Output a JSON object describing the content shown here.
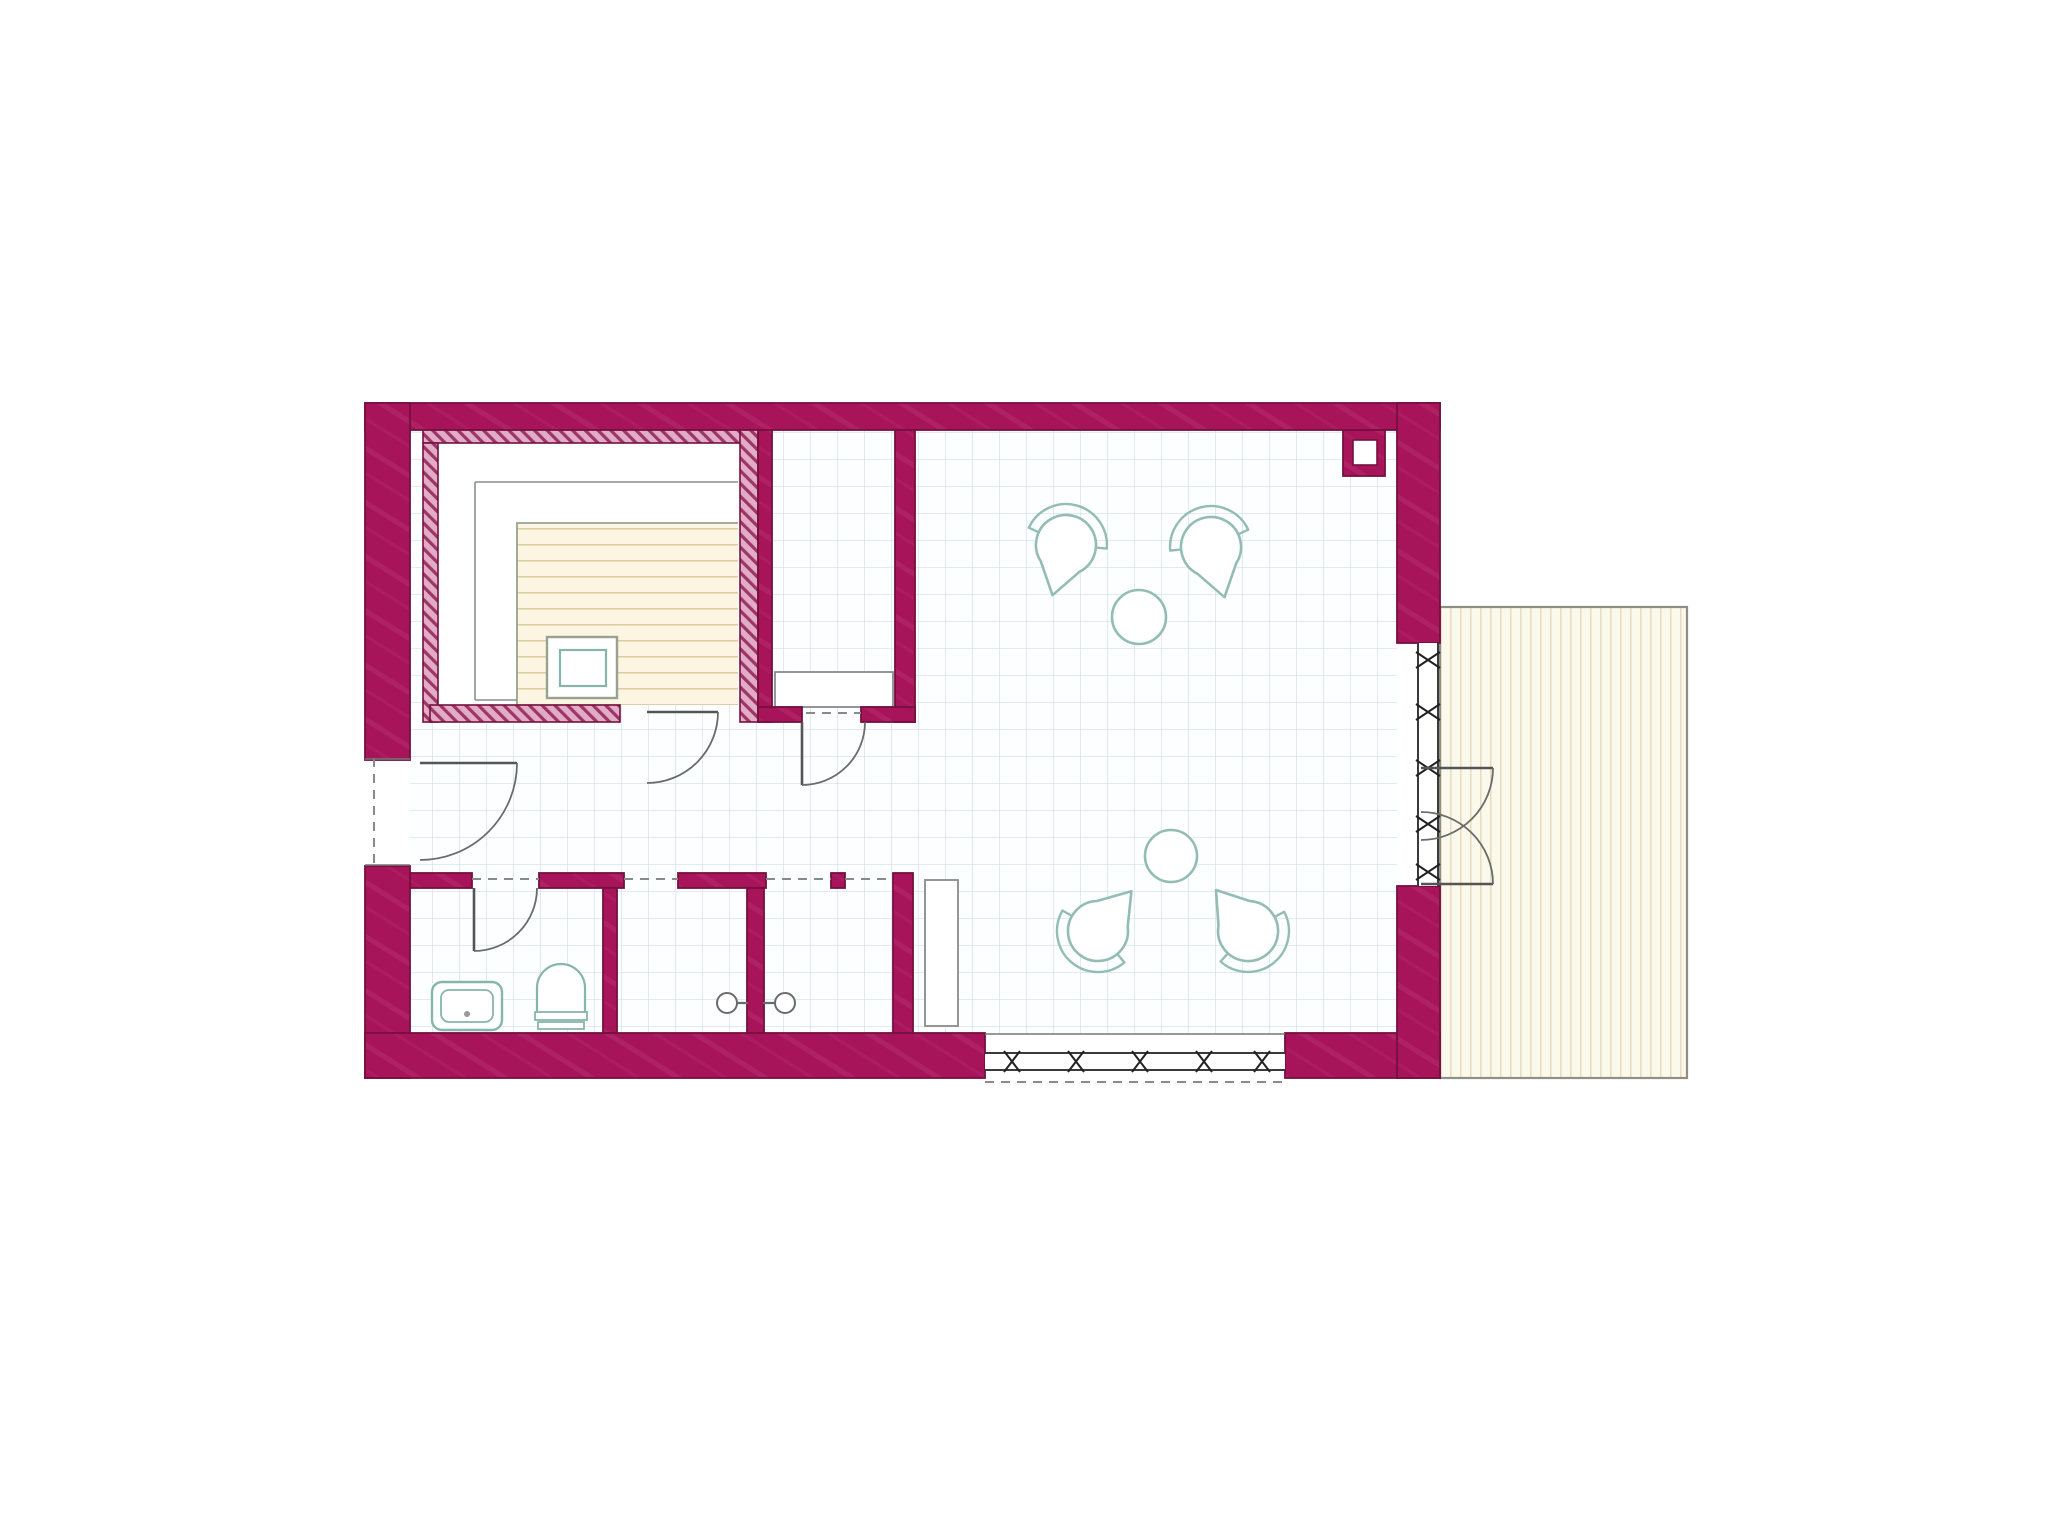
{
  "canvas": {
    "width": 2048,
    "height": 1538,
    "background": "#ffffff"
  },
  "palette": {
    "wall": "#a8145a",
    "wall_light": "#bd4380",
    "wall_edge": "#75103f",
    "hatch_bg": "#e2abc6",
    "hatch_line": "#9c3568",
    "floor": "#fdfeff",
    "grid": "#d2e0ef",
    "furniture_teal": "#93bdb4",
    "fixture_teal": "#86b5ac",
    "line_gray": "#5f5f5f",
    "door_gray": "#555555",
    "dash_gray": "#8a8a8a",
    "bench_gray": "#8a8a8a",
    "tier_gray": "#8a8f8a",
    "slat_bg": "#fbf5e2",
    "slat_line": "#dccfa3",
    "slat_outline": "#98a38f",
    "terrace_bg": "#fbf8ec",
    "terrace_line": "#e8ddbe",
    "terrace_border": "#8f8f86",
    "glass_line": "#3a3a3a"
  },
  "plan": {
    "floor": {
      "x": 410,
      "y": 430,
      "w": 987,
      "h": 603
    },
    "terrace": {
      "x": 1440,
      "y": 607,
      "w": 247,
      "h": 471
    },
    "walls": [
      {
        "name": "outer-wall-top",
        "x": 365,
        "y": 403,
        "w": 1075,
        "h": 27
      },
      {
        "name": "outer-wall-left-upper",
        "x": 365,
        "y": 403,
        "w": 45,
        "h": 357
      },
      {
        "name": "outer-wall-left-lower",
        "x": 365,
        "y": 866,
        "w": 45,
        "h": 212
      },
      {
        "name": "outer-wall-bottom-left",
        "x": 365,
        "y": 1033,
        "w": 620,
        "h": 45
      },
      {
        "name": "outer-wall-bottom-right",
        "x": 1285,
        "y": 1033,
        "w": 155,
        "h": 45
      },
      {
        "name": "outer-wall-right-upper",
        "x": 1397,
        "y": 403,
        "w": 43,
        "h": 240
      },
      {
        "name": "outer-wall-right-lower",
        "x": 1397,
        "y": 886,
        "w": 43,
        "h": 192
      },
      {
        "name": "changing-room-wall-left",
        "x": 758,
        "y": 430,
        "w": 14,
        "h": 292
      },
      {
        "name": "changing-room-wall-right",
        "x": 895,
        "y": 430,
        "w": 20,
        "h": 292
      },
      {
        "name": "changing-room-wall-stub-left",
        "x": 758,
        "y": 707,
        "w": 44,
        "h": 15
      },
      {
        "name": "changing-room-wall-stub-right",
        "x": 861,
        "y": 707,
        "w": 54,
        "h": 15
      },
      {
        "name": "bottom-rooms-wall-top-1",
        "x": 410,
        "y": 873,
        "w": 62,
        "h": 15
      },
      {
        "name": "bottom-rooms-wall-top-2",
        "x": 539,
        "y": 873,
        "w": 85,
        "h": 15
      },
      {
        "name": "bottom-rooms-wall-top-3",
        "x": 678,
        "y": 873,
        "w": 88,
        "h": 15
      },
      {
        "name": "bottom-rooms-wall-top-4",
        "x": 831,
        "y": 873,
        "w": 14,
        "h": 15
      },
      {
        "name": "bathroom-wall-right",
        "x": 603,
        "y": 888,
        "w": 14,
        "h": 145
      },
      {
        "name": "shower-partition-wall",
        "x": 747,
        "y": 888,
        "w": 17,
        "h": 145
      },
      {
        "name": "bottom-rooms-wall-right",
        "x": 893,
        "y": 873,
        "w": 20,
        "h": 160
      },
      {
        "name": "flue-block",
        "x": 1343,
        "y": 430,
        "w": 42,
        "h": 46
      }
    ],
    "flue_hole": {
      "x": 1353,
      "y": 440,
      "w": 24,
      "h": 25
    },
    "hatched_walls": [
      {
        "name": "sauna-wall-top",
        "x": 423,
        "y": 428,
        "w": 335,
        "h": 15
      },
      {
        "name": "sauna-wall-left",
        "x": 423,
        "y": 443,
        "w": 15,
        "h": 279
      },
      {
        "name": "sauna-wall-right",
        "x": 740,
        "y": 428,
        "w": 18,
        "h": 294
      },
      {
        "name": "sauna-wall-bottom",
        "x": 430,
        "y": 705,
        "w": 190,
        "h": 17
      }
    ],
    "sauna": {
      "interior": {
        "x": 438,
        "y": 443,
        "w": 302,
        "h": 262
      },
      "tier_lines": [
        [
          738,
          482,
          475,
          482
        ],
        [
          475,
          482,
          475,
          700
        ],
        [
          475,
          700,
          517,
          700
        ]
      ],
      "slat_area": {
        "x": 517,
        "y": 523,
        "w": 221,
        "h": 182
      },
      "stove_outer": {
        "x": 547,
        "y": 637,
        "w": 70,
        "h": 61
      },
      "stove_inner": {
        "x": 560,
        "y": 650,
        "w": 46,
        "h": 36
      }
    },
    "benches": [
      {
        "name": "changing-room-bench",
        "x": 775,
        "y": 672,
        "w": 118,
        "h": 35
      },
      {
        "name": "main-room-bench",
        "x": 925,
        "y": 880,
        "w": 33,
        "h": 146
      }
    ],
    "windows": [
      {
        "name": "terrace-window-band",
        "orientation": "v",
        "x": 1418,
        "y": 643,
        "w": 20,
        "len": 243,
        "marks": [
          660,
          712,
          768,
          824,
          872
        ]
      },
      {
        "name": "south-window-band",
        "orientation": "h",
        "x": 985,
        "y": 1053,
        "w": 17,
        "len": 300,
        "marks": [
          1012,
          1076,
          1140,
          1204,
          1262
        ]
      }
    ],
    "doors": [
      {
        "name": "entrance-door",
        "hinge": [
          420,
          763
        ],
        "angle": 0,
        "sweep": 90,
        "r": 97
      },
      {
        "name": "sauna-door",
        "hinge": [
          647,
          712
        ],
        "angle": 0,
        "sweep": 90,
        "r": 71
      },
      {
        "name": "changing-room-door",
        "hinge": [
          802,
          722
        ],
        "angle": 90,
        "sweep": -90,
        "r": 63
      },
      {
        "name": "bathroom-door",
        "hinge": [
          474,
          888
        ],
        "angle": 90,
        "sweep": -90,
        "r": 63
      },
      {
        "name": "terrace-door-leaf-top",
        "hinge": [
          1421,
          768
        ],
        "angle": 0,
        "sweep": 90,
        "r": 72
      },
      {
        "name": "terrace-door-leaf-bottom",
        "hinge": [
          1421,
          884
        ],
        "angle": 0,
        "sweep": -90,
        "r": 72
      }
    ],
    "dashed_lines": [
      {
        "name": "entrance-threshold-dash",
        "x1": 374,
        "y1": 758,
        "x2": 374,
        "y2": 866
      },
      {
        "name": "bathroom-lintel-dash",
        "x1": 472,
        "y1": 879,
        "x2": 539,
        "y2": 879
      },
      {
        "name": "shower1-lintel-dash",
        "x1": 624,
        "y1": 879,
        "x2": 678,
        "y2": 879
      },
      {
        "name": "shower2-lintel-dash",
        "x1": 766,
        "y1": 879,
        "x2": 831,
        "y2": 879
      },
      {
        "name": "passage-lintel-dash",
        "x1": 845,
        "y1": 879,
        "x2": 893,
        "y2": 879
      },
      {
        "name": "changing-door-lintel-dash",
        "x1": 806,
        "y1": 713,
        "x2": 861,
        "y2": 713
      },
      {
        "name": "south-window-outer-dash",
        "x1": 985,
        "y1": 1082,
        "x2": 1285,
        "y2": 1082
      }
    ],
    "thin_lines": [
      {
        "name": "entrance-jamb-top",
        "x1": 365,
        "y1": 759,
        "x2": 410,
        "y2": 759
      },
      {
        "name": "entrance-jamb-bottom",
        "x1": 365,
        "y1": 865,
        "x2": 410,
        "y2": 865
      },
      {
        "name": "south-window-floor-edge",
        "x1": 985,
        "y1": 1034,
        "x2": 1285,
        "y2": 1034
      }
    ],
    "bath": {
      "sink_outer": {
        "x": 432,
        "y": 982,
        "w": 70,
        "h": 48
      },
      "sink_inner": {
        "x": 441,
        "y": 990,
        "w": 52,
        "h": 32
      },
      "sink_drain": {
        "cx": 467,
        "cy": 1014,
        "r": 3
      },
      "toilet_bowl": {
        "x1": 537,
        "x2": 585,
        "ytop": 988,
        "ybase": 1012,
        "r": 24
      },
      "toilet_cistern1": {
        "x": 535,
        "y": 1012,
        "w": 52,
        "h": 8
      },
      "toilet_cistern2": {
        "x": 538,
        "y": 1022,
        "w": 46,
        "h": 7
      },
      "showers": [
        {
          "name": "shower-head-left",
          "cx": 727,
          "cy": 1003,
          "r": 10,
          "stem_to_x": 748
        },
        {
          "name": "shower-head-right",
          "cx": 785,
          "cy": 1003,
          "r": 10,
          "stem_to_x": 763
        }
      ]
    },
    "tables": [
      {
        "name": "table-upper",
        "cx": 1139,
        "cy": 617,
        "r": 27
      },
      {
        "name": "table-lower",
        "cx": 1171,
        "cy": 856,
        "r": 26
      }
    ],
    "chairs": [
      {
        "name": "chair-upper-left",
        "cx": 1066,
        "cy": 545,
        "theta": 105
      },
      {
        "name": "chair-upper-right",
        "cx": 1211,
        "cy": 547,
        "theta": 75
      },
      {
        "name": "chair-lower-left",
        "cx": 1098,
        "cy": 931,
        "theta": -50
      },
      {
        "name": "chair-lower-right",
        "cx": 1248,
        "cy": 931,
        "theta": -128
      }
    ],
    "chair_shape": {
      "r_seat": 30,
      "r_back": 41,
      "tip": 52
    }
  }
}
